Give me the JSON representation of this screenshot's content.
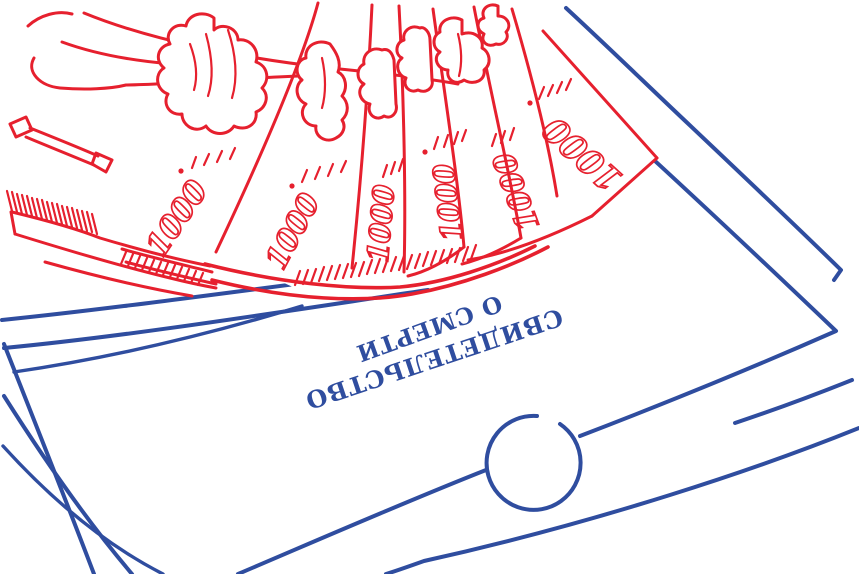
{
  "scene": {
    "kind": "hand-drawn sketch",
    "background_color": "#ffffff",
    "red_ink": "#e6202e",
    "blue_ink": "#2f4d9f"
  },
  "certificate": {
    "title_line1": "СВИДЕТЕЛЬСТВО",
    "title_line2": "О СМЕРТИ",
    "orientation": "upside-down",
    "has_round_seal_placeholder": true,
    "has_double_ruled_border": true
  },
  "money": {
    "denomination": "1000",
    "labels": [
      "1000",
      "1000",
      "1000",
      "1000",
      "1000",
      "1000"
    ],
    "visible_note_count": 8
  }
}
